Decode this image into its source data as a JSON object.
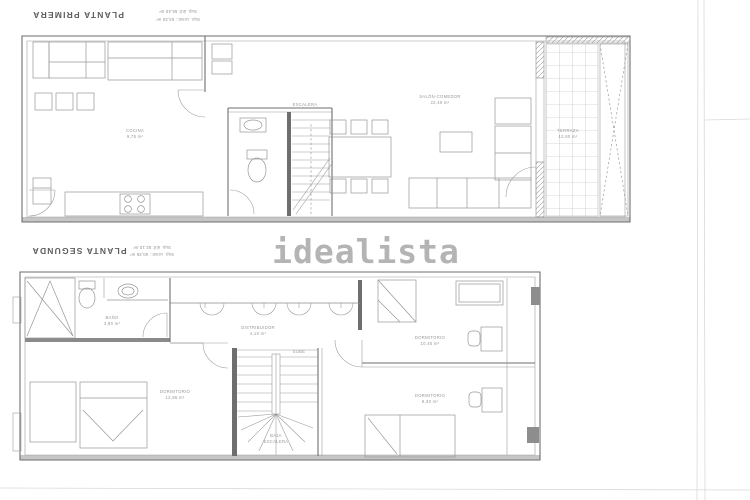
{
  "image": {
    "kind": "scanned floor plan",
    "background": "#ffffff"
  },
  "colors": {
    "line": "#8a8a8a",
    "wall": "#6e6e6e",
    "watermark": "#b4b4b4",
    "scan_shadow": "#c6c6c6"
  },
  "watermark": {
    "text": "idealista"
  },
  "plan_first": {
    "title": "PLANTA PRIMERA",
    "note1": "Sup. útil: 55,40 m²",
    "note2": "Sup. const.: 63,20 m²",
    "labels": {
      "kitchen1": "COCINA",
      "kitchen2": "9,75 m²",
      "stairs": "ESCALERA",
      "living1": "SALÓN-COMEDOR",
      "living2": "22,40 m²",
      "terrace1": "TERRAZA",
      "terrace2": "12,60 m²"
    }
  },
  "plan_second": {
    "title": "PLANTA SEGUNDA",
    "note1": "Sup. útil: 52,10 m²",
    "note2": "Sup. const.: 60,35 m²",
    "labels": {
      "bath1": "BAÑO",
      "bath2": "3,90 m²",
      "hall1": "DISTRIBUIDOR",
      "hall2": "4,10 m²",
      "stairs_up": "SUBE",
      "stairs_dn1": "BAJA",
      "stairs_dn2": "ESCALERA",
      "bed1a": "DORMITORIO",
      "bed1b": "12,85 m²",
      "bed2a": "DORMITORIO",
      "bed2b": "10,40 m²",
      "bed3a": "DORMITORIO",
      "bed3b": "9,30 m²"
    }
  }
}
